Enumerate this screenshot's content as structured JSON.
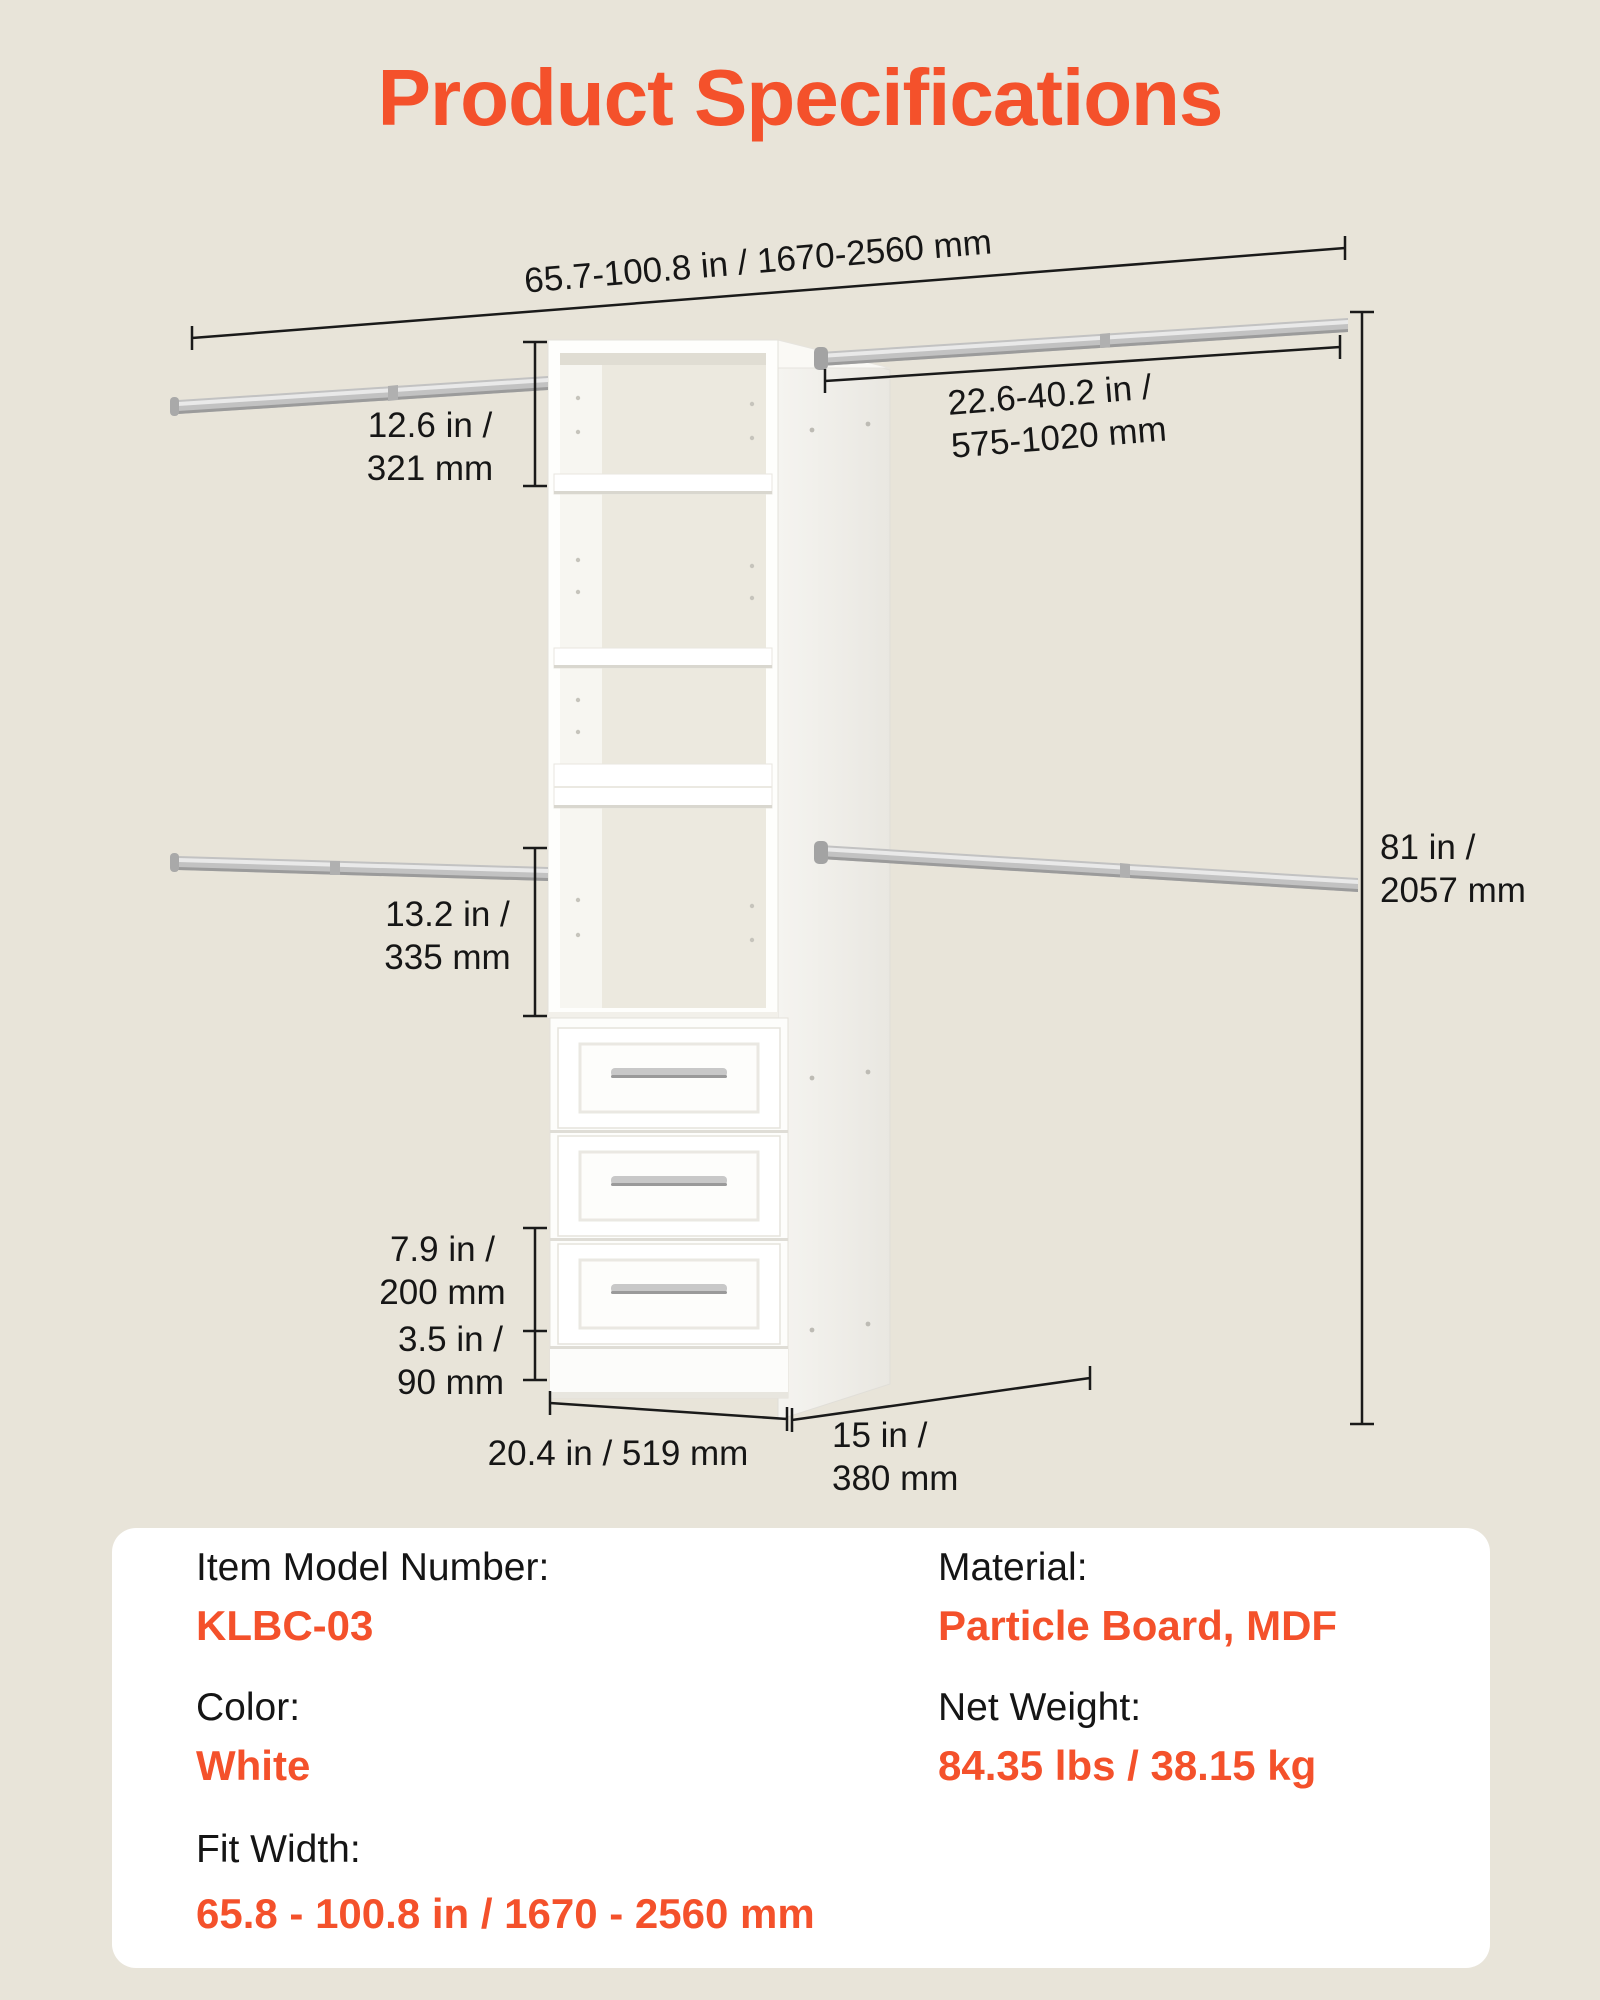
{
  "title": "Product Specifications",
  "colors": {
    "accent": "#F4512B",
    "background": "#E8E4D9",
    "text": "#161616",
    "panel_bg": "#FFFFFF",
    "closet_white": "#FFFFFF",
    "rod_gray": "#C2C2C2"
  },
  "diagram": {
    "total_width": "65.7-100.8 in / 1670-2560 mm",
    "top_section_height": {
      "line1": "12.6 in /",
      "line2": "321 mm"
    },
    "rod_length": {
      "line1": "22.6-40.2 in /",
      "line2": "575-1020 mm"
    },
    "total_height": {
      "line1": "81 in /",
      "line2": "2057 mm"
    },
    "middle_section_height": {
      "line1": "13.2 in /",
      "line2": "335 mm"
    },
    "drawer_height": {
      "line1": "7.9 in /",
      "line2": "200 mm"
    },
    "base_height": {
      "line1": "3.5 in /",
      "line2": "90 mm"
    },
    "unit_width": "20.4 in / 519 mm",
    "unit_depth": {
      "line1": "15 in /",
      "line2": "380 mm"
    }
  },
  "specs": {
    "left": [
      {
        "label": "Item Model Number:",
        "value": "KLBC-03"
      },
      {
        "label": "Color:",
        "value": "White"
      },
      {
        "label": "Fit Width:",
        "value": "65.8 - 100.8 in / 1670 - 2560 mm"
      }
    ],
    "right": [
      {
        "label": "Material:",
        "value": "Particle Board, MDF"
      },
      {
        "label": "Net Weight:",
        "value": "84.35 lbs / 38.15 kg"
      }
    ]
  }
}
